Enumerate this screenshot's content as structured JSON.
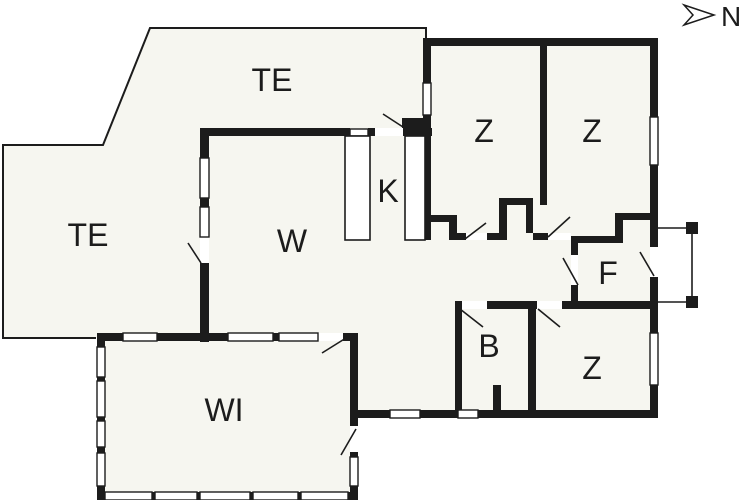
{
  "compass": {
    "label": "N"
  },
  "rooms": [
    {
      "id": "te-top",
      "label": "TE"
    },
    {
      "id": "te-left",
      "label": "TE"
    },
    {
      "id": "w",
      "label": "W"
    },
    {
      "id": "k",
      "label": "K"
    },
    {
      "id": "z1",
      "label": "Z"
    },
    {
      "id": "z2",
      "label": "Z"
    },
    {
      "id": "z3",
      "label": "Z"
    },
    {
      "id": "f",
      "label": "F"
    },
    {
      "id": "b",
      "label": "B"
    },
    {
      "id": "wi",
      "label": "WI"
    }
  ],
  "colors": {
    "wall": "#1c1c1c",
    "floor": "#f6f6f0",
    "background": "#ffffff"
  }
}
